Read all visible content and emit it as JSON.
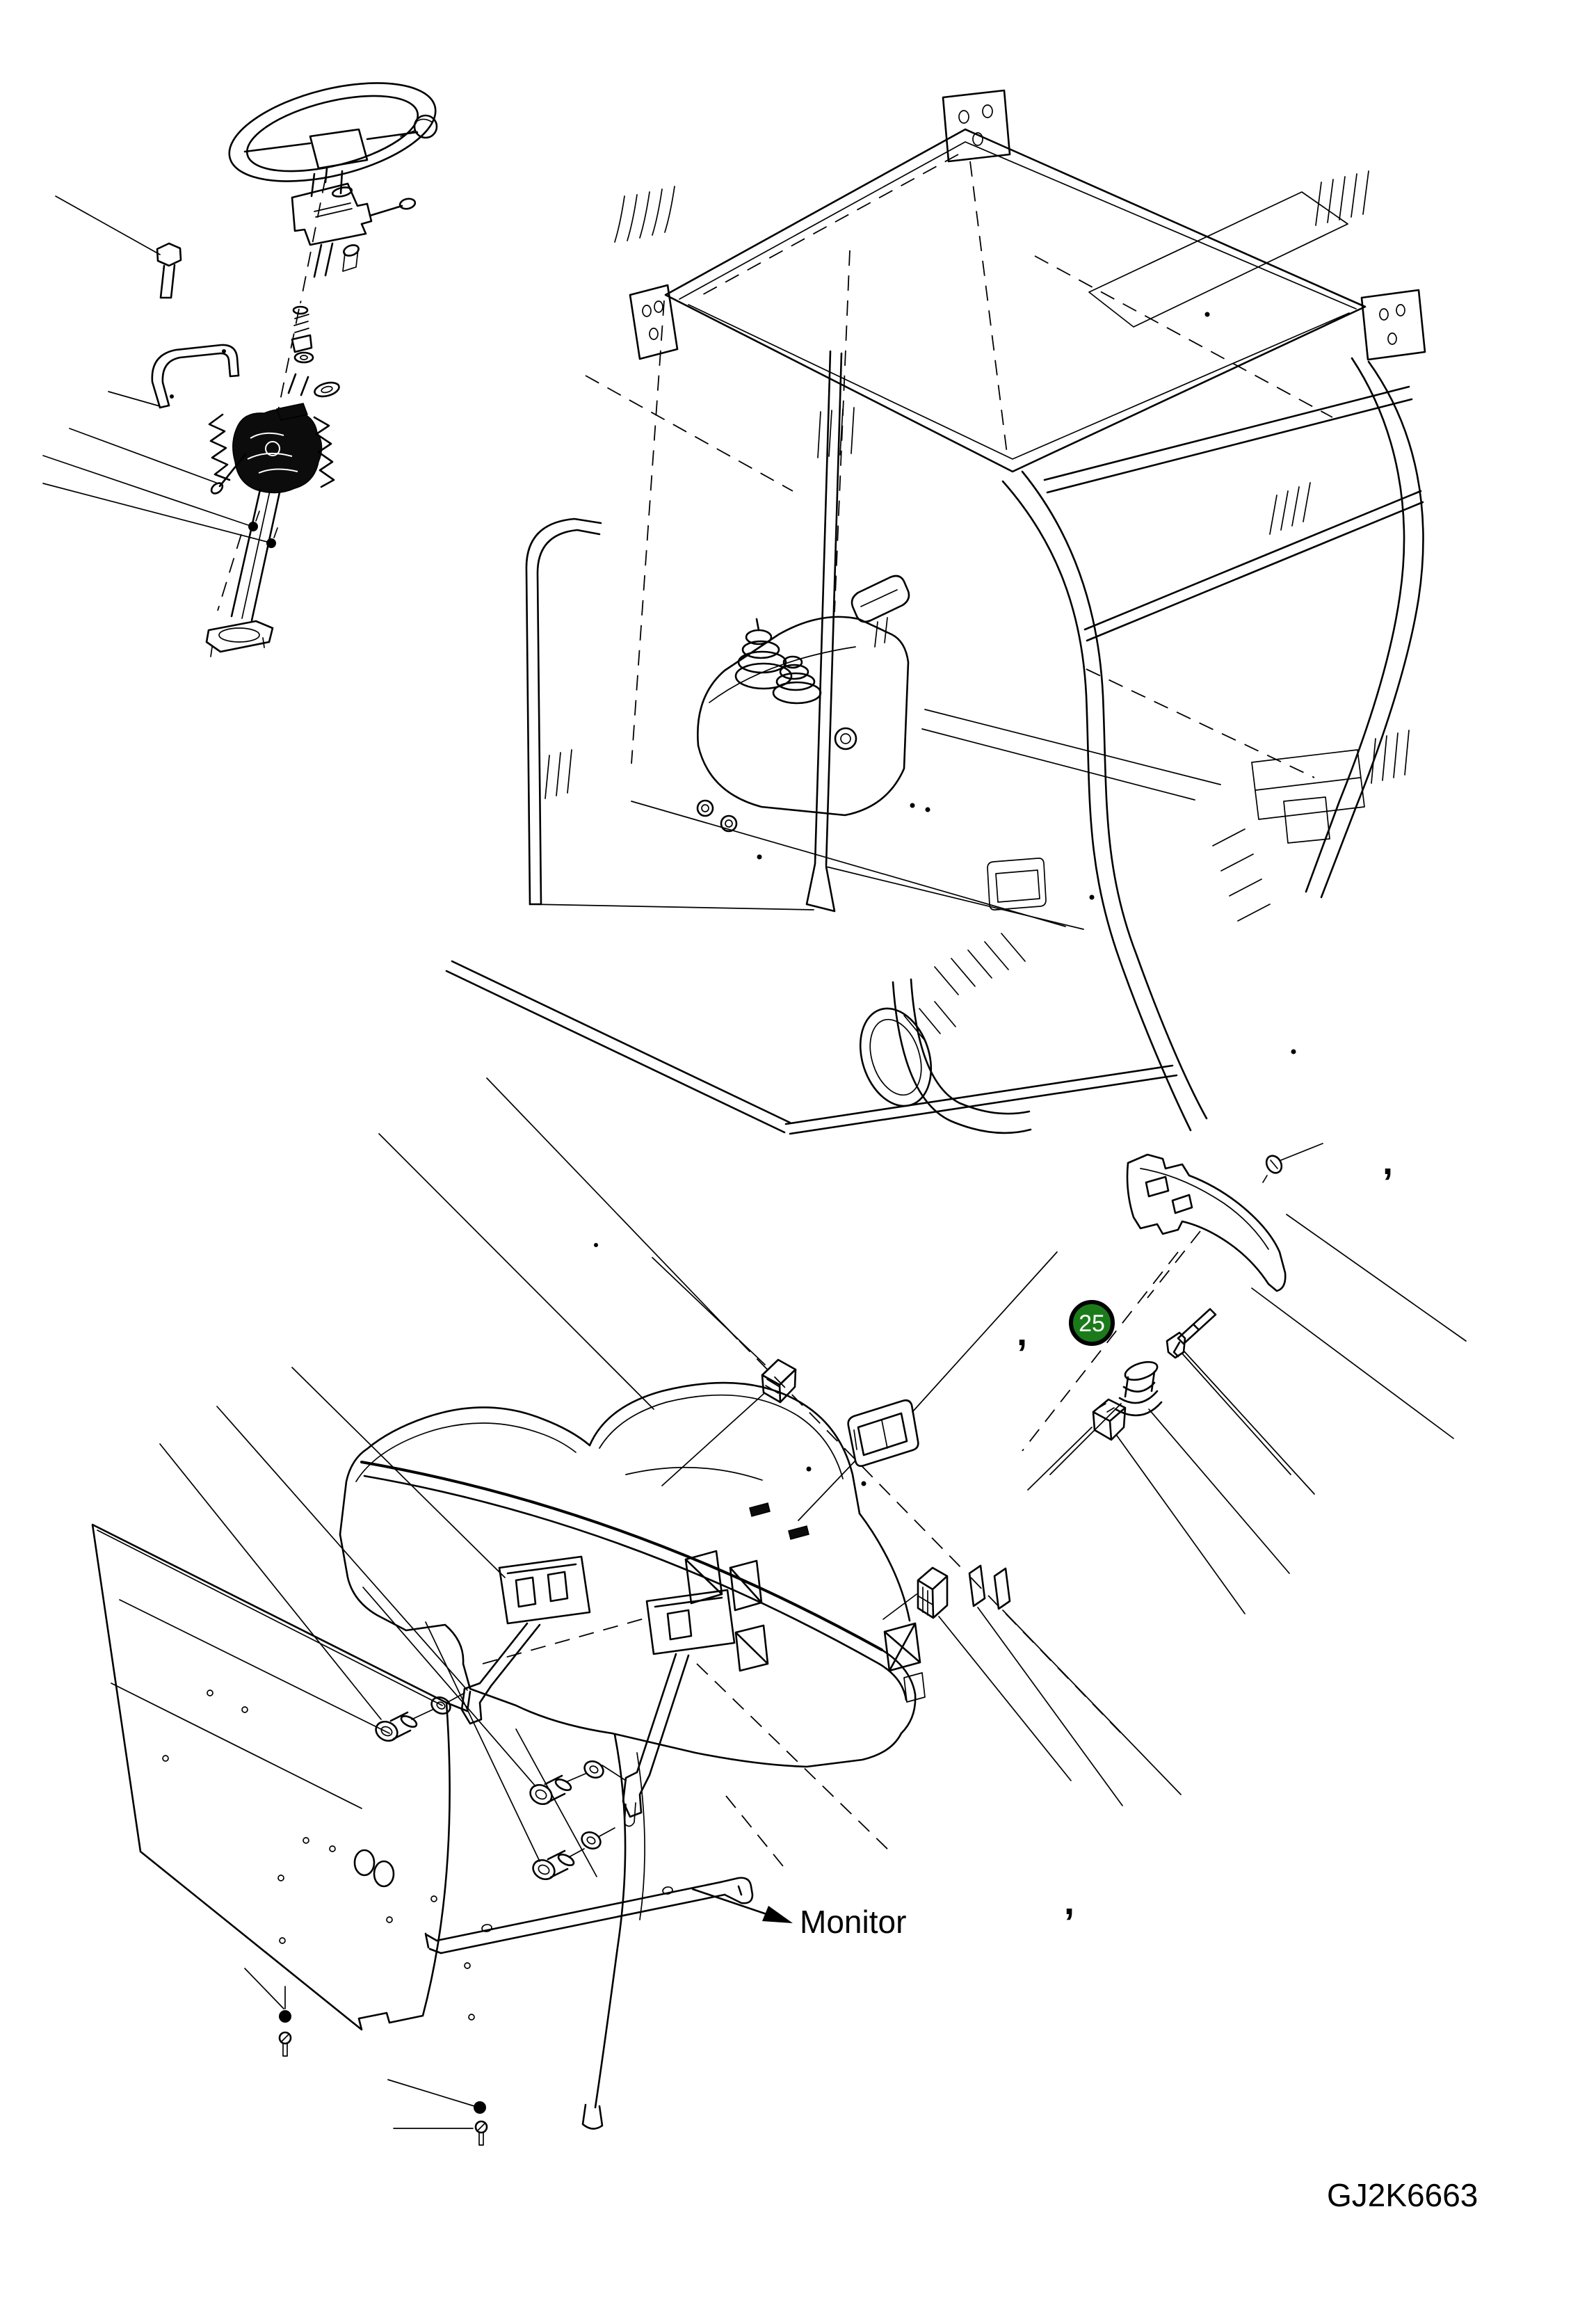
{
  "figure": {
    "type": "exploded-parts-diagram",
    "description": "Exploded view line drawing of operator cab: steering wheel and column assembly, cab frame with control console, dashboard / instrument panel with mounting brackets, bolts and floor panel"
  },
  "labels": {
    "callout_number": "25",
    "monitor": "Monitor",
    "drawing_code": "GJ2K6663",
    "comma_marks": [
      ",",
      ",",
      ","
    ]
  },
  "colors": {
    "callout_fill": "#1b7b1b",
    "callout_ring": "#000000",
    "callout_text": "#ffffff",
    "line": "#000000",
    "background": "#ffffff"
  }
}
